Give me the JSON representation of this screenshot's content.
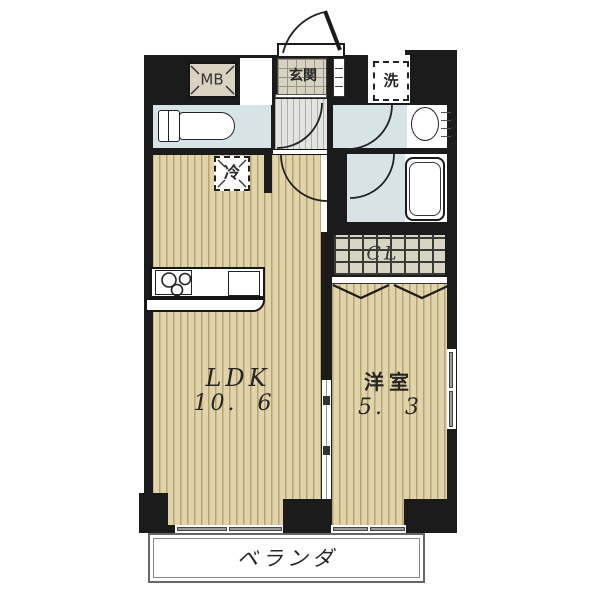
{
  "plan": {
    "rooms": {
      "ldk_label": "LDK",
      "ldk_size": "10.  6",
      "bedroom_label": "洋室",
      "bedroom_size": "5.  3",
      "closet_label": "CL",
      "veranda_label": "ベランダ",
      "entrance_label": "玄関"
    },
    "fixtures": {
      "meter_box_label": "MB",
      "laundry_label": "洗",
      "refrigerator_label": "冷"
    },
    "colors": {
      "wall": "#1b1b1b",
      "wood_floor": "#e2d4aa",
      "water_room": "#d6e3e7",
      "entrance_tile": "#d8d2c0",
      "closet_fill": "#d9d5c5",
      "window_sill": "#9a9a9a"
    }
  }
}
